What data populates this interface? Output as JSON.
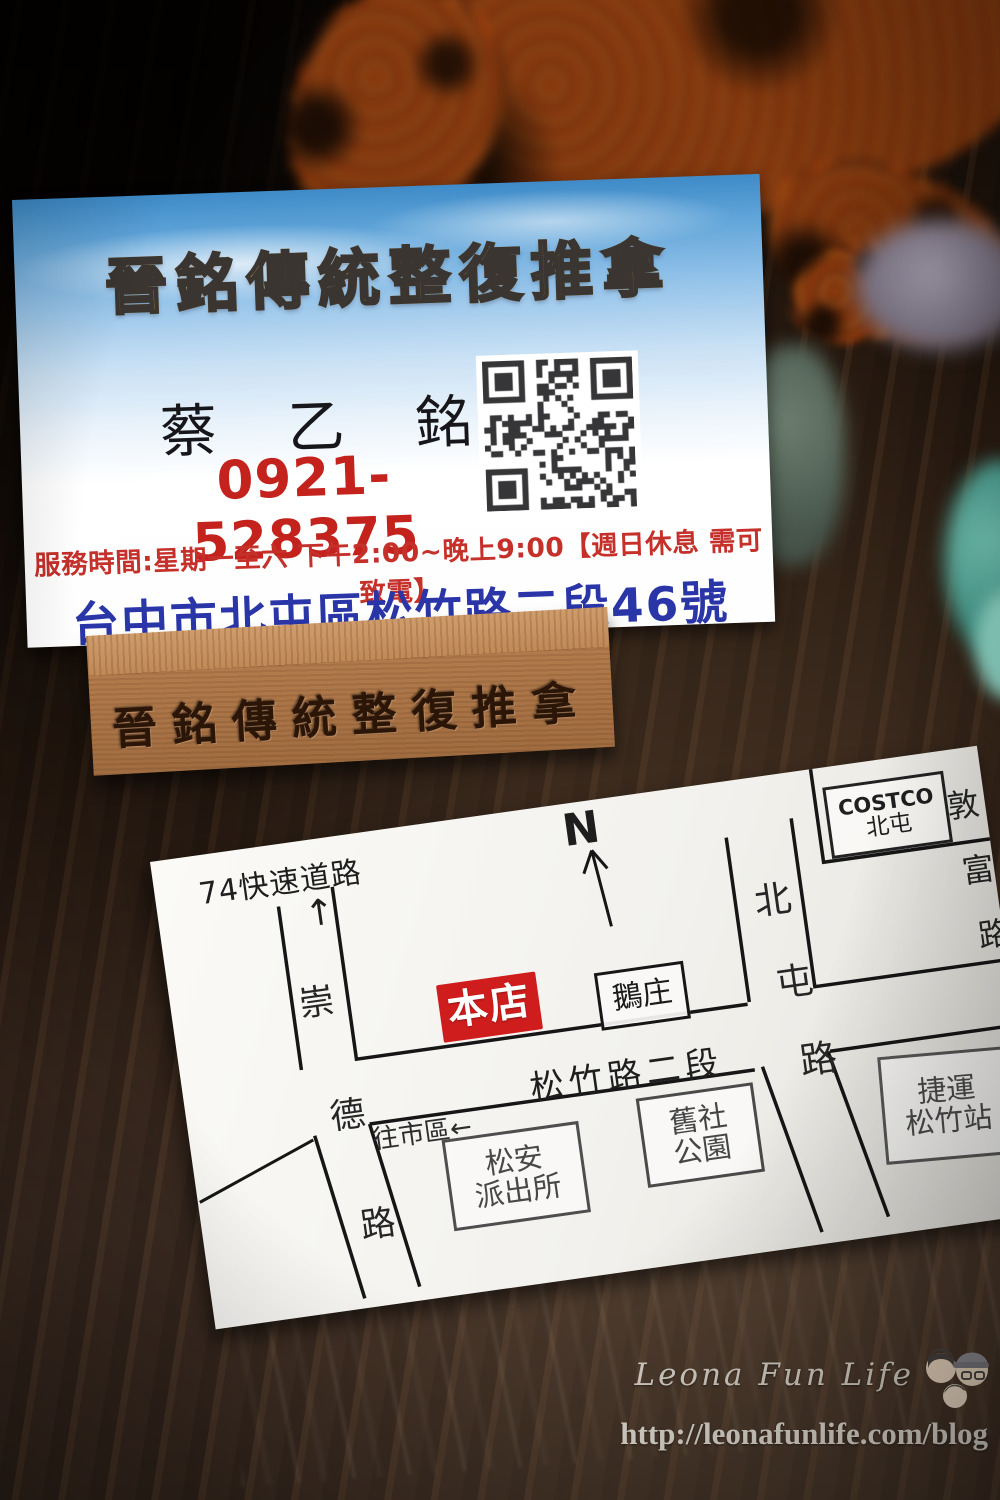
{
  "business_card": {
    "title": "晉銘傳統整復推拿",
    "name_chars": [
      "蔡",
      "乙",
      "銘"
    ],
    "phone": "0921-528375",
    "hours": "服務時間:星期一至六 下午2:00~晚上9:00【週日休息 需可致電】",
    "address": "台中市北屯區松竹路二段46號",
    "colors": {
      "title_gold": "#ecc443",
      "phone_red": "#c3231c",
      "hours_red": "#c5302a",
      "address_blue": "#2a35a8"
    }
  },
  "wood_stand": {
    "engraving": "晉銘傳統整復推拿"
  },
  "map_card": {
    "expressway_label": "74快速道路",
    "up_arrow": "↑",
    "compass_n": "N",
    "shop_marker": "本店",
    "shop_marker_color": "#cf1d1d",
    "goose_restaurant": "鵝庄",
    "road_songzhu": "松竹路二段",
    "to_city": "往市區←",
    "costco": {
      "line1": "COSTCO",
      "line2": "北屯"
    },
    "police": {
      "line1": "松安",
      "line2": "派出所"
    },
    "park": {
      "line1": "舊社",
      "line2": "公園"
    },
    "mrt": {
      "line1": "捷運",
      "line2": "松竹站"
    },
    "road_chongde_chars": [
      "崇",
      "德",
      "路"
    ],
    "road_beitun_chars": [
      "北",
      "屯",
      "路"
    ],
    "road_dunfu_chars": [
      "敦",
      "富",
      "路"
    ]
  },
  "watermark": {
    "site_name": "Leona Fun Life",
    "url": "http://leonafunlife.com/blog"
  },
  "icons": {
    "qr": "qr-code-icon",
    "family": "family-avatar-icon",
    "north_arrow": "north-arrow-icon"
  }
}
